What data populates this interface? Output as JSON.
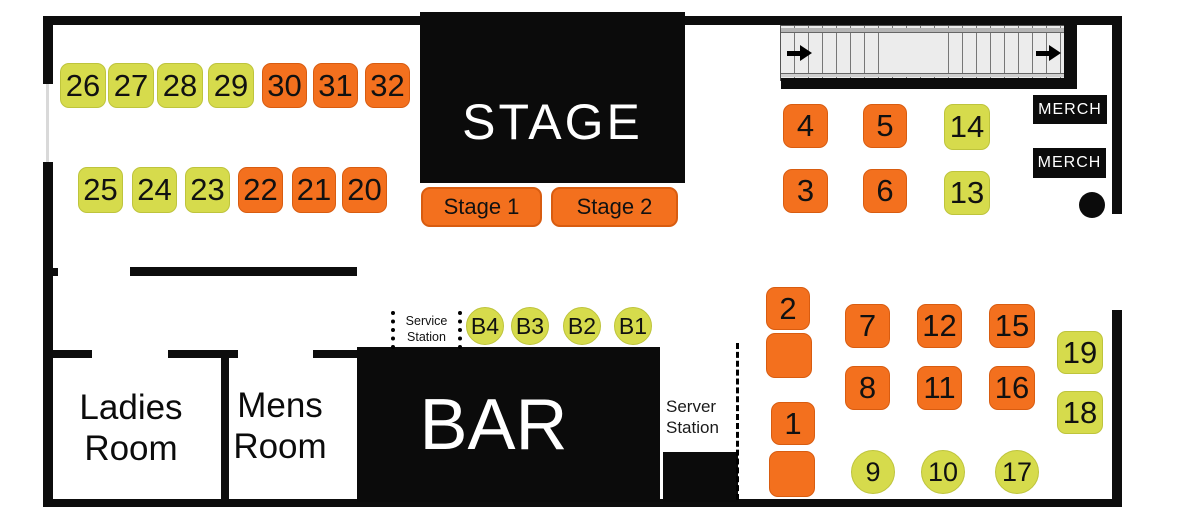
{
  "palette": {
    "orange": "#F3701E",
    "yellow_green": "#D6DB4C",
    "wall": "#0d0d0d"
  },
  "stage": {
    "label": "STAGE",
    "sub_stages": [
      "Stage 1",
      "Stage 2"
    ]
  },
  "bar": {
    "label": "BAR"
  },
  "rooms": {
    "ladies": [
      "Ladies",
      "Room"
    ],
    "mens": [
      "Mens",
      "Room"
    ]
  },
  "stations": {
    "service": [
      "Service",
      "Station"
    ],
    "server": [
      "Server",
      "Station"
    ]
  },
  "merch_stands": [
    "MERCH",
    "MERCH"
  ],
  "tables": [
    {
      "label": "26",
      "shape": "square",
      "color": "yellow",
      "x": 60,
      "y": 63,
      "w": 46,
      "h": 45
    },
    {
      "label": "27",
      "shape": "square",
      "color": "yellow",
      "x": 108,
      "y": 63,
      "w": 46,
      "h": 45
    },
    {
      "label": "28",
      "shape": "square",
      "color": "yellow",
      "x": 157,
      "y": 63,
      "w": 46,
      "h": 45
    },
    {
      "label": "29",
      "shape": "square",
      "color": "yellow",
      "x": 208,
      "y": 63,
      "w": 46,
      "h": 45
    },
    {
      "label": "30",
      "shape": "square",
      "color": "orange",
      "x": 262,
      "y": 63,
      "w": 45,
      "h": 45
    },
    {
      "label": "31",
      "shape": "square",
      "color": "orange",
      "x": 313,
      "y": 63,
      "w": 45,
      "h": 45
    },
    {
      "label": "32",
      "shape": "square",
      "color": "orange",
      "x": 365,
      "y": 63,
      "w": 45,
      "h": 45
    },
    {
      "label": "25",
      "shape": "square",
      "color": "yellow",
      "x": 78,
      "y": 167,
      "w": 45,
      "h": 46
    },
    {
      "label": "24",
      "shape": "square",
      "color": "yellow",
      "x": 132,
      "y": 167,
      "w": 45,
      "h": 46
    },
    {
      "label": "23",
      "shape": "square",
      "color": "yellow",
      "x": 185,
      "y": 167,
      "w": 45,
      "h": 46
    },
    {
      "label": "22",
      "shape": "square",
      "color": "orange",
      "x": 238,
      "y": 167,
      "w": 45,
      "h": 46
    },
    {
      "label": "21",
      "shape": "square",
      "color": "orange",
      "x": 292,
      "y": 167,
      "w": 44,
      "h": 46
    },
    {
      "label": "20",
      "shape": "square",
      "color": "orange",
      "x": 342,
      "y": 167,
      "w": 45,
      "h": 46
    },
    {
      "label": "4",
      "shape": "square",
      "color": "orange",
      "x": 783,
      "y": 104,
      "w": 45,
      "h": 44
    },
    {
      "label": "5",
      "shape": "square",
      "color": "orange",
      "x": 863,
      "y": 104,
      "w": 44,
      "h": 44
    },
    {
      "label": "14",
      "shape": "square",
      "color": "yellow",
      "x": 944,
      "y": 104,
      "w": 46,
      "h": 46
    },
    {
      "label": "3",
      "shape": "square",
      "color": "orange",
      "x": 783,
      "y": 169,
      "w": 45,
      "h": 44
    },
    {
      "label": "6",
      "shape": "square",
      "color": "orange",
      "x": 863,
      "y": 169,
      "w": 44,
      "h": 44
    },
    {
      "label": "13",
      "shape": "square",
      "color": "yellow",
      "x": 944,
      "y": 171,
      "w": 46,
      "h": 44
    },
    {
      "label": "2",
      "shape": "square",
      "color": "orange",
      "x": 766,
      "y": 287,
      "w": 44,
      "h": 43
    },
    {
      "label": "",
      "shape": "square",
      "color": "orange",
      "x": 766,
      "y": 333,
      "w": 46,
      "h": 45
    },
    {
      "label": "7",
      "shape": "square",
      "color": "orange",
      "x": 845,
      "y": 304,
      "w": 45,
      "h": 44
    },
    {
      "label": "12",
      "shape": "square",
      "color": "orange",
      "x": 917,
      "y": 304,
      "w": 45,
      "h": 44
    },
    {
      "label": "15",
      "shape": "square",
      "color": "orange",
      "x": 989,
      "y": 304,
      "w": 46,
      "h": 44
    },
    {
      "label": "8",
      "shape": "square",
      "color": "orange",
      "x": 845,
      "y": 366,
      "w": 45,
      "h": 44
    },
    {
      "label": "11",
      "shape": "square",
      "color": "orange",
      "x": 917,
      "y": 366,
      "w": 45,
      "h": 44
    },
    {
      "label": "16",
      "shape": "square",
      "color": "orange",
      "x": 989,
      "y": 366,
      "w": 46,
      "h": 44
    },
    {
      "label": "19",
      "shape": "square",
      "color": "yellow",
      "x": 1057,
      "y": 331,
      "w": 46,
      "h": 43
    },
    {
      "label": "18",
      "shape": "square",
      "color": "yellow",
      "x": 1057,
      "y": 391,
      "w": 46,
      "h": 43
    },
    {
      "label": "1",
      "shape": "square",
      "color": "orange",
      "x": 771,
      "y": 402,
      "w": 44,
      "h": 43
    },
    {
      "label": "",
      "shape": "square",
      "color": "orange",
      "x": 769,
      "y": 451,
      "w": 46,
      "h": 46
    },
    {
      "label": "9",
      "shape": "circle",
      "color": "yellow",
      "x": 851,
      "y": 450,
      "w": 44,
      "h": 44
    },
    {
      "label": "10",
      "shape": "circle",
      "color": "yellow",
      "x": 921,
      "y": 450,
      "w": 44,
      "h": 44
    },
    {
      "label": "17",
      "shape": "circle",
      "color": "yellow",
      "x": 995,
      "y": 450,
      "w": 44,
      "h": 44
    },
    {
      "label": "B4",
      "shape": "circle",
      "color": "yellow",
      "x": 466,
      "y": 307,
      "w": 38,
      "h": 38
    },
    {
      "label": "B3",
      "shape": "circle",
      "color": "yellow",
      "x": 511,
      "y": 307,
      "w": 38,
      "h": 38
    },
    {
      "label": "B2",
      "shape": "circle",
      "color": "yellow",
      "x": 563,
      "y": 307,
      "w": 38,
      "h": 38
    },
    {
      "label": "B1",
      "shape": "circle",
      "color": "yellow",
      "x": 614,
      "y": 307,
      "w": 38,
      "h": 38
    }
  ]
}
